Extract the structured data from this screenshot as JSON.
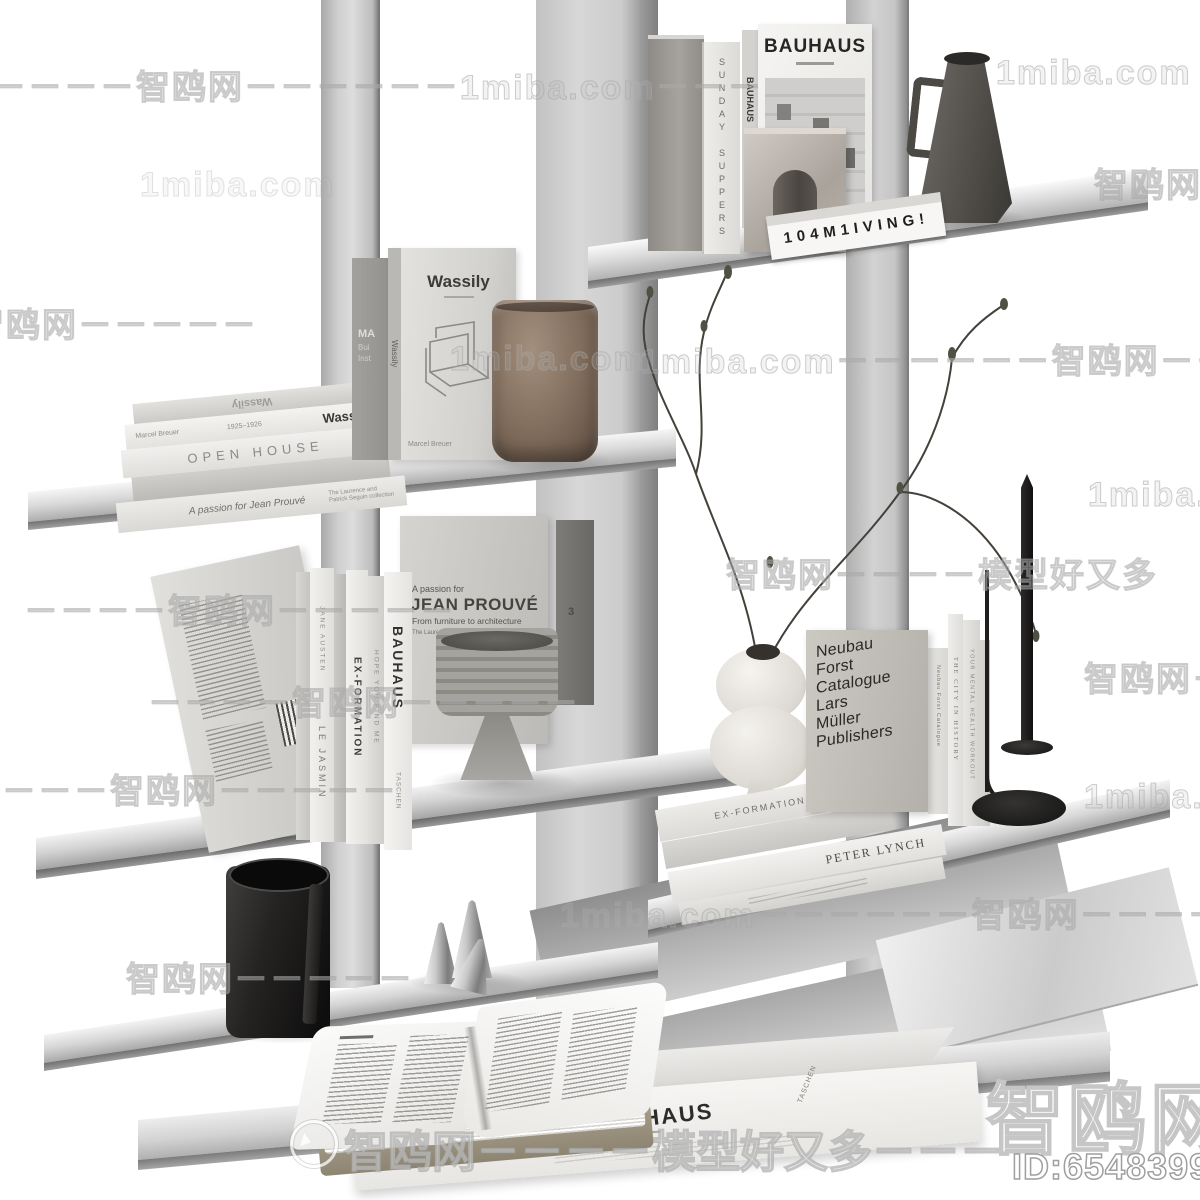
{
  "meta": {
    "site_name": "智鸥网",
    "site_domain": "1miba.com",
    "tagline": "模型好又多",
    "model_id": "ID:654839997"
  },
  "watermarks": {
    "line_dash_zhi_miba": "－－－－－智鸥网－－－－－－1miba.com－－－",
    "miba": "1miba.com",
    "zhi": "智鸥网",
    "zhi_dashes": "智鸥网－－－－－",
    "dashes_zhi": "－－－－智鸥网－－－－－",
    "miba_dash_zhi": "1miba.com－－－－－－智鸥网－－－－",
    "zhi_model": "智鸥网－－－－模型好又多",
    "bottom_line": "智鸥网－－－－模型好又多－－－－",
    "corner_logo": "智鸥网",
    "corner_id": "ID:654839997"
  },
  "shelf_top_right": {
    "sunday_spine": "SUNDAY SUPPERS",
    "bauhaus_mag_spine": "BAUHAUS",
    "bauhaus_mag_title": "BAUHAUS",
    "living_spine": "104M1IVING!"
  },
  "shelf_left_upper": {
    "top_foreedge": "Wassily",
    "wassily_spine_author": "Marcel Breuer",
    "wassily_spine_years": "1925–1926",
    "wassily_spine_title": "Wassily",
    "open_house_spine": "OPEN HOUSE",
    "prouve_spine": "A passion for Jean Prouvé",
    "prouve_spine_small_1": "The Laurence and",
    "prouve_spine_small_2": "Patrick Seguin collection",
    "standing_title": "Wassily",
    "standing_spine": "Wassily",
    "standing_author": "Marcel Breuer",
    "behind_line_1": "MA",
    "behind_line_2": "Bui",
    "behind_line_3": "Inst"
  },
  "shelf_left_mid": {
    "spine_jane_top": "JANE AUSTEN",
    "spine_jane": "LE JASMIN",
    "spine_exformation": "EX-FORMATION",
    "spine_hope": "HOPE YOU FIND ME",
    "spine_bauhaus": "BAUHAUS",
    "spine_taschen": "TASCHEN",
    "dark_book_mark": "3",
    "prouve_kicker": "A passion for",
    "prouve_title": "JEAN PROUVÉ",
    "prouve_subtitle": "From furniture to architecture",
    "prouve_small": "The Laurence and Patrick Seguin collection"
  },
  "shelf_right_mid": {
    "neubau_line_0": "Neubau",
    "neubau_line_1": "Forst",
    "neubau_line_2": "Catalogue",
    "neubau_line_3": "Lars",
    "neubau_line_4": "Müller",
    "neubau_line_5": "Publishers",
    "neubau_spine": "Neubau Forst Catalogue",
    "stack_top_cover": "EX-FORMATION",
    "stack_spine_peter": "PETER LYNCH",
    "spine_city": "THE CITY IN HISTORY",
    "spine_mental": "YOUR MENTAL HEALTH WORKOUT"
  },
  "bottom": {
    "bauhaus_spine_author": "ART COBERE",
    "bauhaus_spine_title": "BAUHAUS",
    "bauhaus_spine_publisher": "TASCHEN"
  },
  "colors": {
    "background": "#ffffff",
    "metal_light": "#dedede",
    "metal_mid": "#b5b5b5",
    "metal_dark": "#8c8c8c",
    "book_white": "#f1f0ee",
    "marble": "#b8b2ab",
    "brown_glass": "#84705f",
    "dark_object": "#1d1c1b",
    "watermark_grey": "#a5a5a5"
  }
}
